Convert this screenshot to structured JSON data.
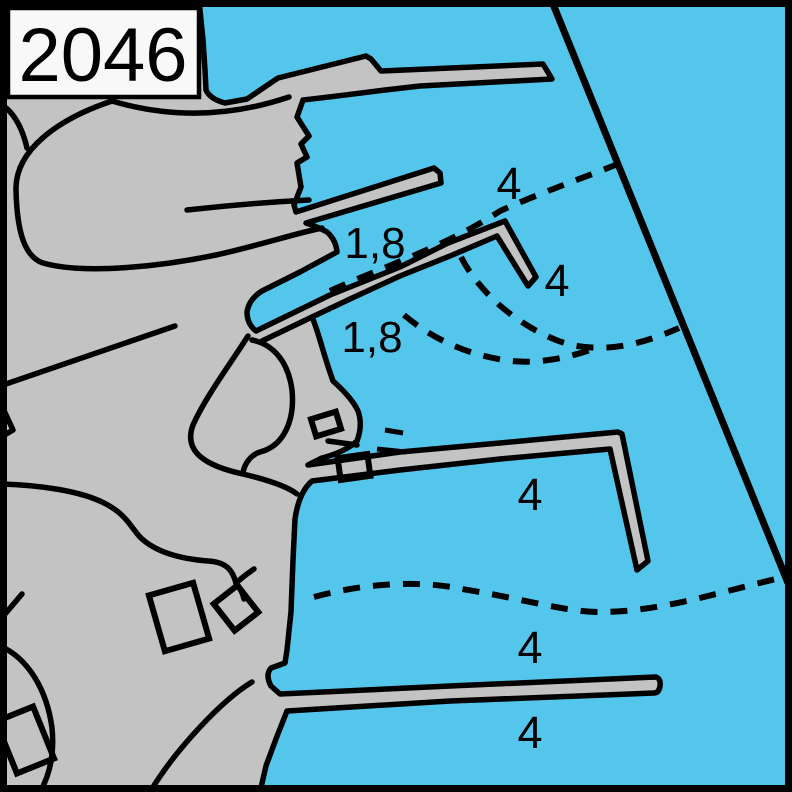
{
  "chart_number": "2046",
  "colors": {
    "water": "#55C6EB",
    "land": "#C3C3C3",
    "outline": "#000000",
    "chart_box_fill": "#F8F8F8",
    "frame": "#000000"
  },
  "soundings": [
    {
      "value": "4",
      "area": "north outer harbour"
    },
    {
      "value": "4",
      "area": "east of north pier head"
    },
    {
      "value": "4",
      "area": "central harbour basin"
    },
    {
      "value": "4",
      "area": "north of south pier"
    },
    {
      "value": "4",
      "area": "south of south pier"
    }
  ],
  "depth_labels": [
    {
      "value": "1,8",
      "area": "inner basin north"
    },
    {
      "value": "1,8",
      "area": "inner basin south"
    }
  ],
  "map_features": {
    "land": "coastline with quays and stepped wharf edges",
    "piers": [
      "north mole",
      "north finger pier",
      "angled pier with elbow head",
      "large L-shaped pier",
      "long south pier"
    ],
    "contours": [
      "north depth contour",
      "basin arc contour upper",
      "basin arc contour lower",
      "south depth contour"
    ],
    "limit_line": "diagonal harbour limit line",
    "buildings": 5
  }
}
